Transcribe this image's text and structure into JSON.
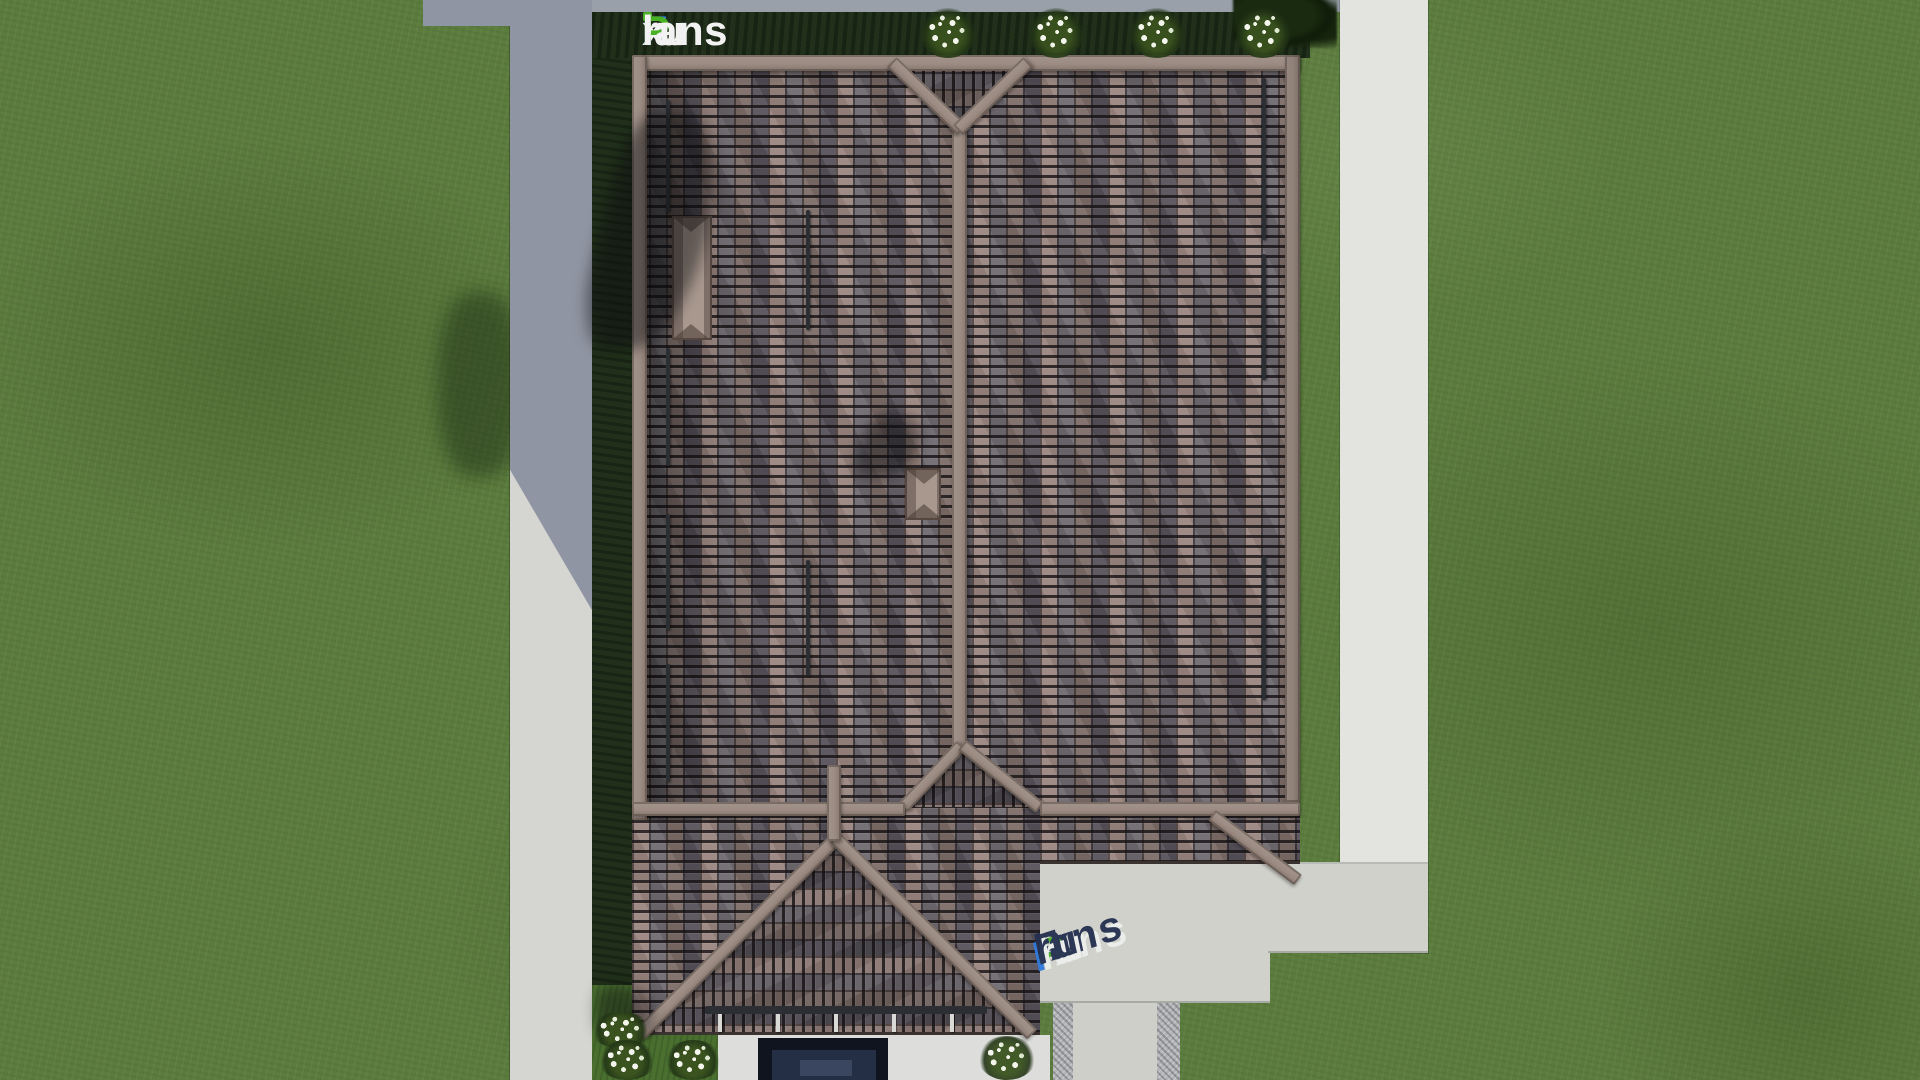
{
  "branding": {
    "logo": {
      "text": "FixPlans.ru",
      "parts": {
        "f": "F",
        "i": "i",
        "x": "x",
        "p": "P",
        "lans": "lans",
        "dot": ".",
        "ru": "ru"
      }
    },
    "watermark": {
      "text": "FixPlans.ru",
      "parts": {
        "f": "F",
        "ix": "ix",
        "p": "P",
        "lans": "lans",
        "dot": ".",
        "ru": "ru"
      }
    }
  },
  "scene": {
    "description": "Top-down 3D render of a hip-roof house plot",
    "objects": [
      "lawn",
      "left-sidewalk",
      "right-footpath",
      "garden-bed",
      "tiled-hip-roof",
      "roof-ridges",
      "dormer",
      "chimney",
      "snow-guards",
      "porch-gable-roof",
      "entrance",
      "paved-slab",
      "gravel-edged-walkway",
      "flower-bushes",
      "tree-shadow"
    ],
    "bush_count_top": 4,
    "bush_count_bottom": 4
  },
  "palette": {
    "grass": "#5b7c3d",
    "bed-dark": "#20301a",
    "bed-light": "#4a7030",
    "pave-shadow": "#8f95a2",
    "pave-light": "#d5d5d1",
    "path": "#e3e3df",
    "slab": "#d1d1cc",
    "gravel": "#b2b4b7",
    "tile-base": "#7b6e6b",
    "ridge": "#9c8c83",
    "guard": "#2b2e33",
    "entrance-dark": "#10141f",
    "entrance-mid": "#242e45",
    "entrance-core": "#3a4660",
    "flower": "#f4f6ee",
    "logo-blue": "#2f7bdc",
    "logo-green": "#49b224",
    "logo-white": "#f2f2f2",
    "wm-navy": "#232f4e",
    "wm-highlight": "#edefec",
    "shadow": "rgba(10,10,14,0.45)"
  }
}
